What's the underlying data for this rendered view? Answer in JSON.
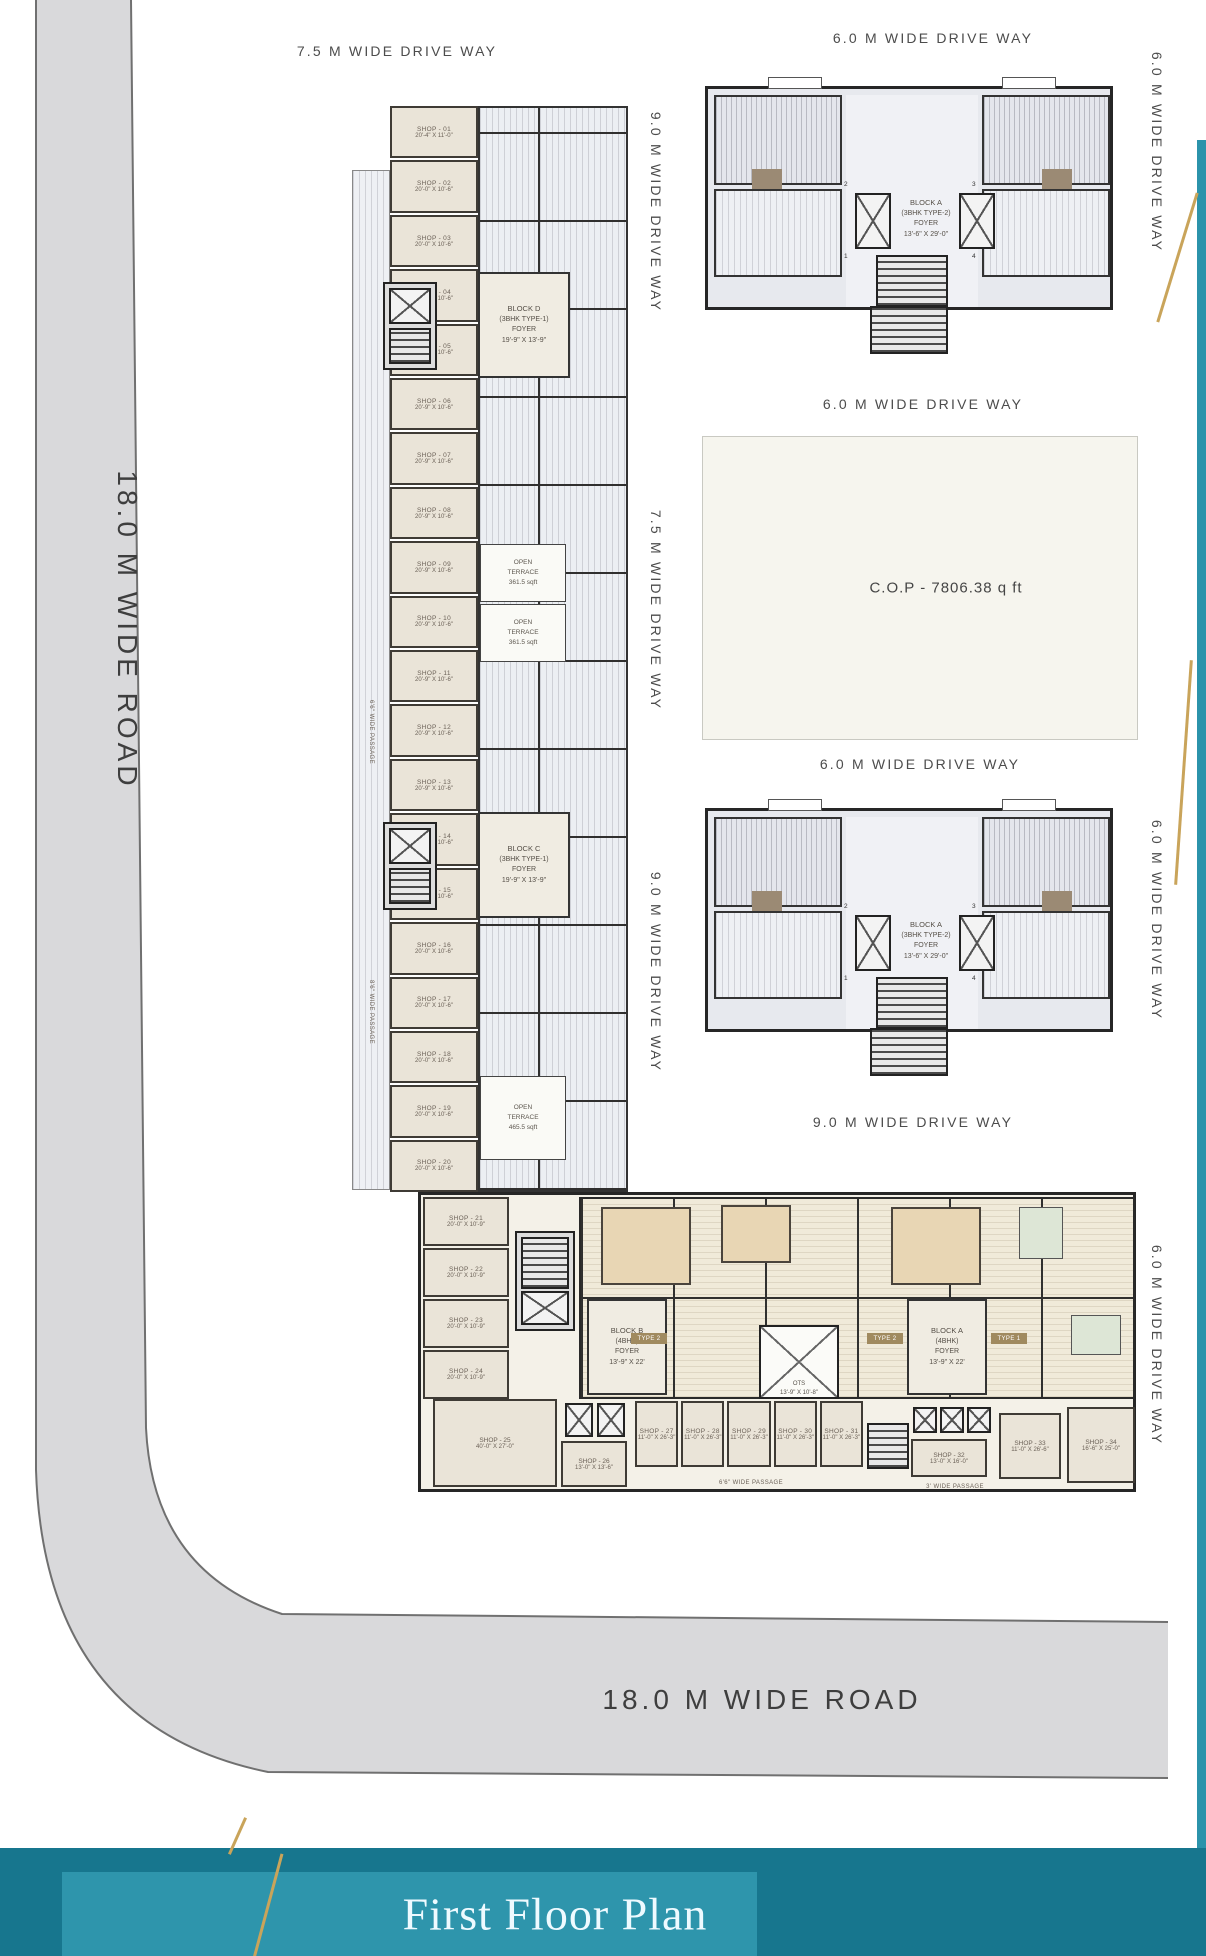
{
  "colors": {
    "road_gray": "#d9d9db",
    "shop_fill": "#eae4d8",
    "apartment_fill": "#e7e9ee",
    "band_teal": "#2e95ac",
    "band_teal_dark": "#17768e",
    "gold_accent": "#c9a45a"
  },
  "roads": {
    "left_label": "18.0 M WIDE ROAD",
    "bottom_label": "18.0 M WIDE ROAD"
  },
  "driveway_labels": [
    {
      "text": "7.5 M WIDE DRIVE WAY"
    },
    {
      "text": "6.0 M WIDE DRIVE WAY"
    },
    {
      "text": "6.0 M WIDE DRIVE WAY"
    },
    {
      "text": "9.0 M WIDE DRIVE WAY"
    },
    {
      "text": "6.0 M WIDE DRIVE WAY"
    },
    {
      "text": "7.5 M WIDE DRIVE WAY"
    },
    {
      "text": "6.0 M WIDE DRIVE WAY"
    },
    {
      "text": "9.0 M WIDE DRIVE WAY"
    },
    {
      "text": "6.0 M WIDE DRIVE WAY"
    },
    {
      "text": "9.0 M WIDE DRIVE WAY"
    },
    {
      "text": "6.0 M WIDE DRIVE WAY"
    }
  ],
  "cop_label": "C.O.P - 7806.38 q ft",
  "blocks": {
    "a1": {
      "line1": "BLOCK A",
      "line2": "(3BHK TYPE-2)",
      "line3": "FOYER",
      "line4": "13'-6\" X 29'-0\"",
      "unit_tags": [
        "2",
        "3",
        "1",
        "4"
      ]
    },
    "a2": {
      "line1": "BLOCK A",
      "line2": "(3BHK TYPE-2)",
      "line3": "FOYER",
      "line4": "13'-6\" X 29'-0\"",
      "unit_tags": [
        "2",
        "3",
        "1",
        "4"
      ]
    },
    "d": {
      "line1": "BLOCK D",
      "line2": "(3BHK TYPE-1)",
      "line3": "FOYER",
      "line4": "19'-9\" X 13'-9\""
    },
    "c": {
      "line1": "BLOCK C",
      "line2": "(3BHK TYPE-1)",
      "line3": "FOYER",
      "line4": "19'-9\" X 13'-9\""
    },
    "b_low": {
      "line1": "BLOCK B",
      "line2": "(4BHK)",
      "line3": "FOYER",
      "line4": "13'-9\" X 22'"
    },
    "a_low": {
      "line1": "BLOCK A",
      "line2": "(4BHK)",
      "line3": "FOYER",
      "line4": "13'-9\" X 22'"
    }
  },
  "terraces": [
    {
      "line1": "OPEN",
      "line2": "TERRACE",
      "line3": "361.5 sqft"
    },
    {
      "line1": "OPEN",
      "line2": "TERRACE",
      "line3": "361.5 sqft"
    },
    {
      "line1": "OPEN",
      "line2": "TERRACE",
      "line3": "465.5 sqft"
    }
  ],
  "ots": {
    "line1": "OTS",
    "line2": "13'-9\" X 10'-8\""
  },
  "type_tags": [
    "TYPE 2",
    "TYPE 2",
    "TYPE 1"
  ],
  "passages": {
    "left_1": "6'6\" WIDE PASSAGE",
    "left_2": "8'6\" WIDE PASSAGE",
    "left_3": "8' WIDE PASSAGE",
    "bottom_1": "6'6\" WIDE PASSAGE",
    "bottom_2": "3' WIDE PASSAGE"
  },
  "shops_left": [
    {
      "no": "SHOP - 01",
      "size": "20'-4\" X 11'-0\""
    },
    {
      "no": "SHOP - 02",
      "size": "20'-0\" X 10'-6\""
    },
    {
      "no": "SHOP - 03",
      "size": "20'-0\" X 10'-6\""
    },
    {
      "no": "SHOP - 04",
      "size": "20'-0\" X 10'-6\""
    },
    {
      "no": "SHOP - 05",
      "size": "20'-9\" X 10'-6\""
    },
    {
      "no": "SHOP - 06",
      "size": "20'-9\" X 10'-6\""
    },
    {
      "no": "SHOP - 07",
      "size": "20'-9\" X 10'-6\""
    },
    {
      "no": "SHOP - 08",
      "size": "20'-9\" X 10'-6\""
    },
    {
      "no": "SHOP - 09",
      "size": "20'-9\" X 10'-6\""
    },
    {
      "no": "SHOP - 10",
      "size": "20'-9\" X 10'-6\""
    },
    {
      "no": "SHOP - 11",
      "size": "20'-9\" X 10'-6\""
    },
    {
      "no": "SHOP - 12",
      "size": "20'-9\" X 10'-6\""
    },
    {
      "no": "SHOP - 13",
      "size": "20'-9\" X 10'-6\""
    },
    {
      "no": "SHOP - 14",
      "size": "20'-9\" X 10'-6\""
    },
    {
      "no": "SHOP - 15",
      "size": "20'-0\" X 10'-6\""
    },
    {
      "no": "SHOP - 16",
      "size": "20'-0\" X 10'-6\""
    },
    {
      "no": "SHOP - 17",
      "size": "20'-0\" X 10'-6\""
    },
    {
      "no": "SHOP - 18",
      "size": "20'-0\" X 10'-6\""
    },
    {
      "no": "SHOP - 19",
      "size": "20'-0\" X 10'-6\""
    },
    {
      "no": "SHOP - 20",
      "size": "20'-0\" X 10'-6\""
    }
  ],
  "shops_left_lower": [
    {
      "no": "SHOP - 21",
      "size": "20'-0\" X 10'-9\""
    },
    {
      "no": "SHOP - 22",
      "size": "20'-0\" X 10'-9\""
    },
    {
      "no": "SHOP - 23",
      "size": "20'-0\" X 10'-9\""
    },
    {
      "no": "SHOP - 24",
      "size": "20'-0\" X 10'-9\""
    }
  ],
  "shops_bottom_row": [
    {
      "no": "SHOP - 27",
      "size": "11'-0\" X 26'-3\""
    },
    {
      "no": "SHOP - 28",
      "size": "11'-0\" X 26'-3\""
    },
    {
      "no": "SHOP - 29",
      "size": "11'-0\" X 26'-3\""
    },
    {
      "no": "SHOP - 30",
      "size": "11'-0\" X 26'-3\""
    },
    {
      "no": "SHOP - 31",
      "size": "11'-0\" X 26'-3\""
    }
  ],
  "shops_misc": {
    "s25": {
      "no": "SHOP - 25",
      "size": "40'-0\" X 27'-0\""
    },
    "s26": {
      "no": "SHOP - 26",
      "size": "13'-0\" X 13'-6\""
    },
    "s32": {
      "no": "SHOP - 32",
      "size": "13'-0\" X 16'-0\""
    },
    "s33": {
      "no": "SHOP - 33",
      "size": "11'-0\" X 26'-6\""
    },
    "s34": {
      "no": "SHOP - 34",
      "size": "16'-6\" X 25'-0\""
    }
  },
  "footer": {
    "title": "First Floor Plan"
  }
}
